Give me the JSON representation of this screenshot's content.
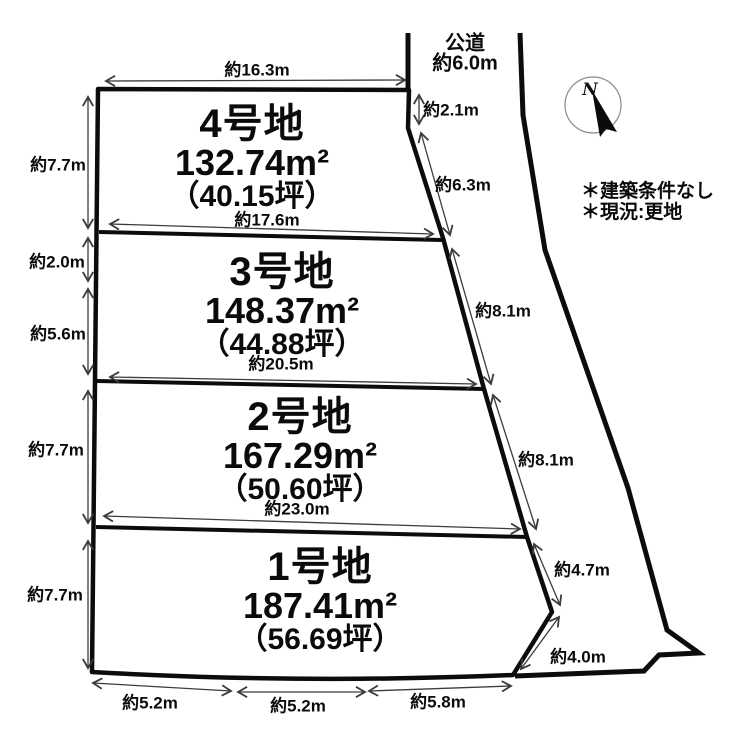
{
  "road": {
    "name": "公道",
    "width": "約6.0m"
  },
  "compass": {
    "north": "N"
  },
  "notes": {
    "line1": "＊建築条件なし",
    "line2": "＊現況:更地"
  },
  "plots": [
    {
      "name": "4号地",
      "area": "132.74m²",
      "tsubo": "（40.15坪）"
    },
    {
      "name": "3号地",
      "area": "148.37m²",
      "tsubo": "（44.88坪）"
    },
    {
      "name": "2号地",
      "area": "167.29m²",
      "tsubo": "（50.60坪）"
    },
    {
      "name": "1号地",
      "area": "187.41m²",
      "tsubo": "（56.69坪）"
    }
  ],
  "dims": {
    "top_16_3": "約16.3m",
    "mid_17_6": "約17.6m",
    "mid_20_5": "約20.5m",
    "mid_23_0": "約23.0m",
    "left_7_7_a": "約7.7m",
    "left_2_0": "約2.0m",
    "left_5_6": "約5.6m",
    "left_7_7_b": "約7.7m",
    "left_7_7_c": "約7.7m",
    "bottom_5_2_a": "約5.2m",
    "bottom_5_2_b": "約5.2m",
    "bottom_5_8": "約5.8m",
    "right_2_1": "約2.1m",
    "right_6_3": "約6.3m",
    "right_8_1_a": "約8.1m",
    "right_8_1_b": "約8.1m",
    "right_4_7": "約4.7m",
    "right_4_0": "約4.0m"
  }
}
